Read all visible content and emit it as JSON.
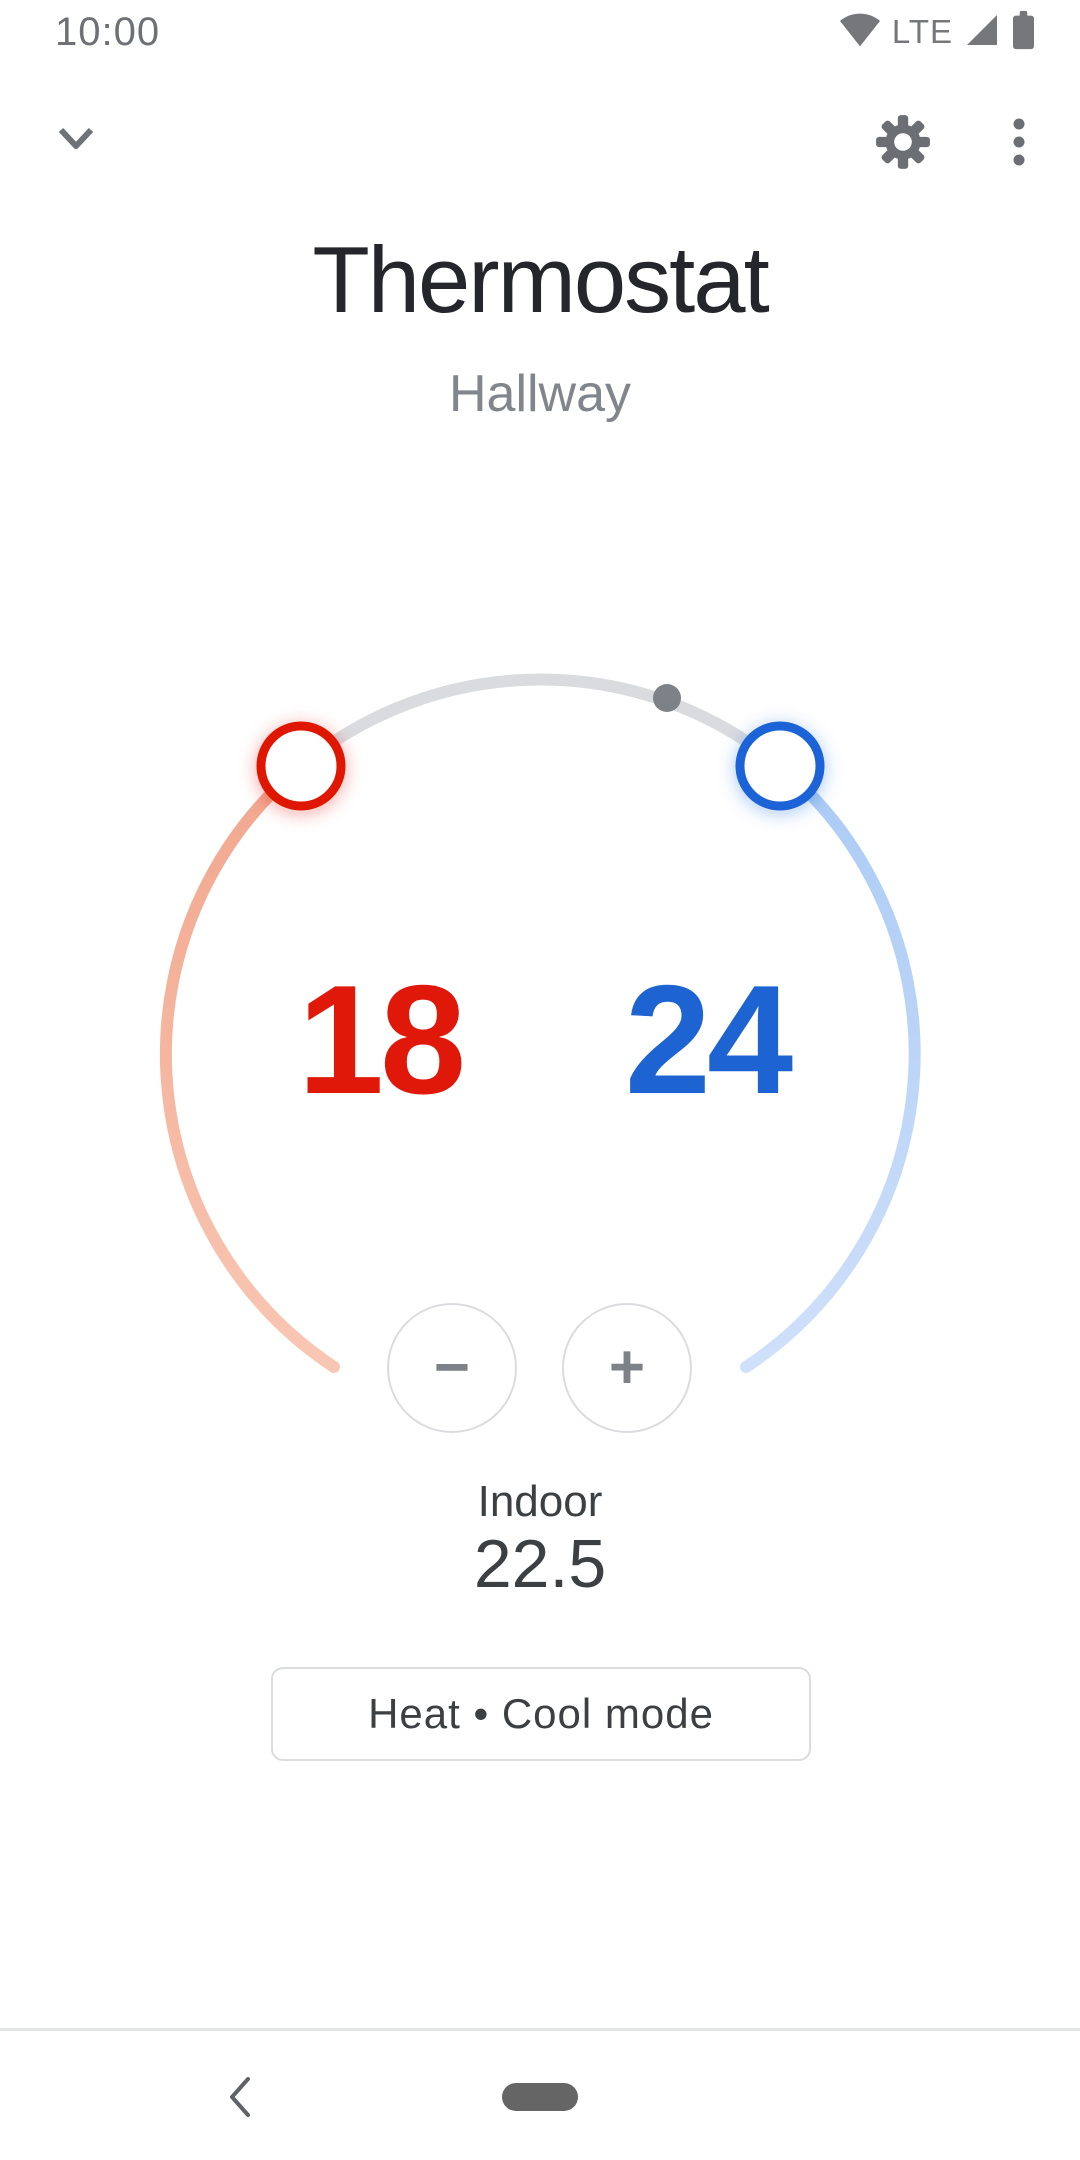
{
  "status_bar": {
    "time": "10:00",
    "network_label": "LTE"
  },
  "header": {
    "title": "Thermostat",
    "subtitle": "Hallway"
  },
  "dial": {
    "heat_setpoint": "18",
    "cool_setpoint": "24"
  },
  "controls": {
    "decrease_label": "−",
    "increase_label": "+"
  },
  "indoor": {
    "label": "Indoor",
    "value": "22.5"
  },
  "mode": {
    "label": "Heat • Cool mode"
  },
  "icons": {
    "collapse": "chevron-down",
    "settings": "gear",
    "more": "three-dot-vertical",
    "wifi": "wifi-full",
    "signal": "cell-signal-full",
    "battery": "battery-full",
    "back": "chevron-left",
    "decrease": "minus",
    "increase": "plus",
    "current_temp_marker": "gray-dot"
  },
  "colors": {
    "heat": "#df1809",
    "cool": "#1e63d2",
    "heat_track_start": "#f2a78e",
    "heat_track_end": "#f8c7b4",
    "cool_track_start": "#abcbf5",
    "cool_track_end": "#cfe0fa",
    "neutral_track": "#d9dbde",
    "marker_dot": "#7d8288",
    "text_primary": "#24262b",
    "text_secondary": "#80868b",
    "outline": "#dadce0"
  }
}
